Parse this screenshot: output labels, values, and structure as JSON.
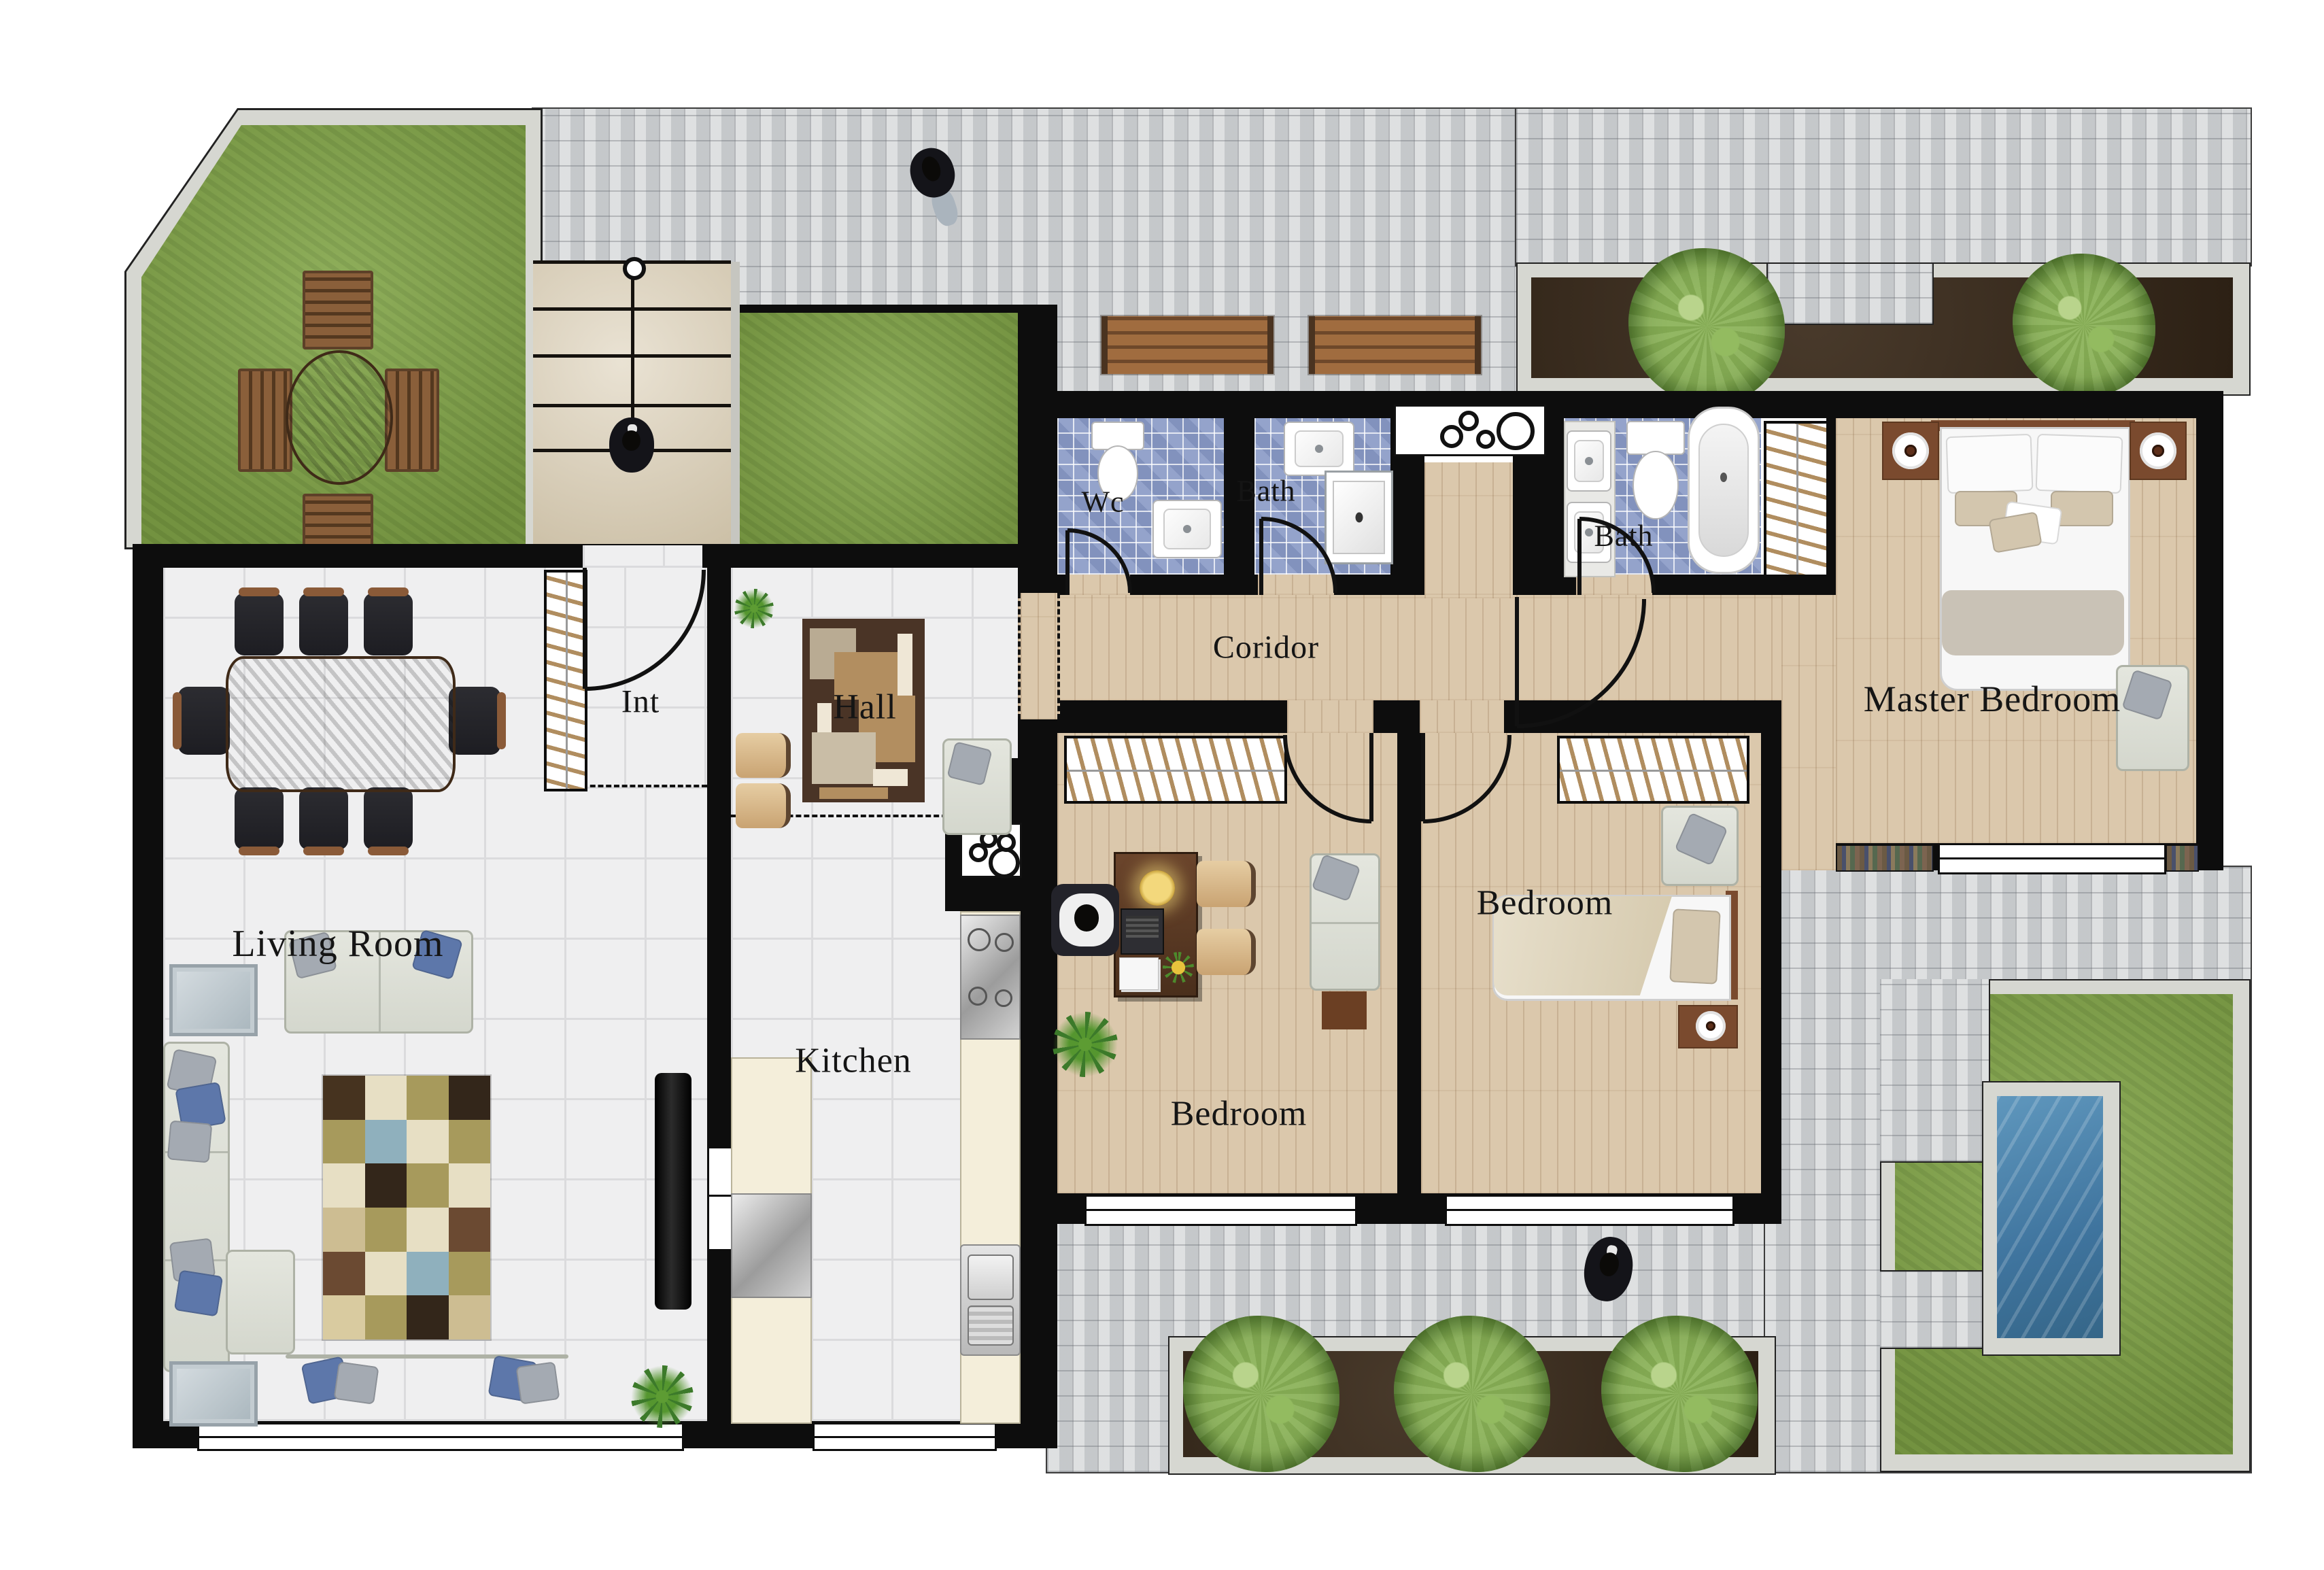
{
  "app": {
    "type": "architectural floor plan, top view"
  },
  "rooms": {
    "living_room": {
      "label": "Living Room"
    },
    "int_closet": {
      "label": "Int"
    },
    "hall": {
      "label": "Hall"
    },
    "kitchen": {
      "label": "Kitchen"
    },
    "wc": {
      "label": "Wc"
    },
    "bath_small": {
      "label": "Bath"
    },
    "bath_main": {
      "label": "Bath"
    },
    "corridor": {
      "label": "Coridor"
    },
    "master_bedroom": {
      "label": "Master Bedroom"
    },
    "bedroom_office": {
      "label": "Bedroom"
    },
    "bedroom_single": {
      "label": "Bedroom"
    }
  },
  "palette": {
    "wall": "#0d0d0d",
    "tile_floor": "#efeff0",
    "wood_floor": "#dbc8ac",
    "mosaic_blue": "#94a3cb",
    "grass": "#83a649",
    "paver": "#d2d4d6",
    "soil": "#3b2b1b",
    "pool_water": "#3f749e",
    "counter_cream": "#f4eeda",
    "stairs_beige": "#d8cbb0",
    "sofa_gray": "#e0e2da",
    "pillow_blue": "#5d77aa",
    "wood_furniture": "#5a3a22",
    "rug_brown": "#4a3426"
  },
  "rugs": {
    "living": {
      "columns": 4,
      "rows": 6,
      "cells": [
        "#46331f",
        "#e7dfc4",
        "#a79a5c",
        "#33261a",
        "#a79a5c",
        "#8fb0bd",
        "#e7dfc4",
        "#a79a5c",
        "#e7dfc4",
        "#33261a",
        "#a79a5c",
        "#e7dfc4",
        "#cdbd92",
        "#a79a5c",
        "#e7dfc4",
        "#6b4a32",
        "#6b4a32",
        "#e7dfc4",
        "#8fb0bd",
        "#a79a5c",
        "#d9cba0",
        "#a79a5c",
        "#33261a",
        "#cdbd92"
      ]
    }
  }
}
